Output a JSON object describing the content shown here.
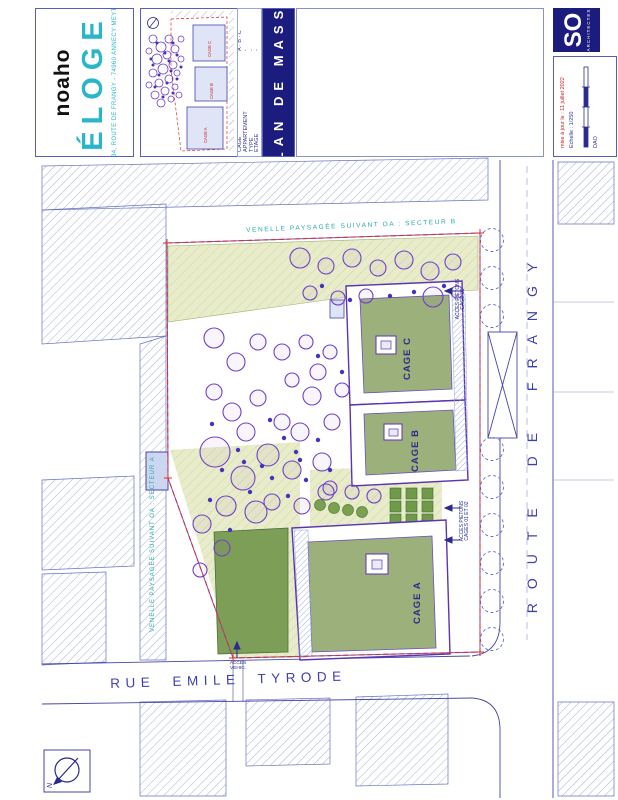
{
  "header": {
    "brand": {
      "name": "noaho",
      "project": "ÉLOGE",
      "address": "30 - 34, ROUTE DE FRANGY - 74960 ANNECY MEYTHET"
    },
    "cartouche": [
      {
        "label": "CAGE",
        "value": "A · B · C"
      },
      {
        "label": "APPARTEMENT",
        "value": "-"
      },
      {
        "label": "TYPE",
        "value": "-"
      },
      {
        "label": "ETAGE",
        "value": "-"
      }
    ],
    "banner_title": "PLAN DE MASSE",
    "architect": {
      "logo": "SO",
      "tagline": "architectes"
    },
    "infobox": {
      "updated": "mise à jour le : 11 juillet 2022",
      "scale": "Echelle : 1/250",
      "dao": "DAO"
    }
  },
  "plan": {
    "street_south": "RUE EMILE TYRODE",
    "street_east": "ROUTE DE FRANGY",
    "venelle_top": "VENELLE PAYSAGÉE SUIVANT OA : SECTEUR B",
    "venelle_left": "VENELLE PAYSAGÉE SUIVANT OA : SECTEUR A",
    "access_piet_c": {
      "line1": "ACCES PIETONS",
      "line2": "CAGE 03"
    },
    "access_piet_ab": {
      "line1": "ACCES PIETONS",
      "line2": "CAGES 01 ET 02"
    },
    "access_veh": {
      "line1": "ACCES",
      "line2": "VEHIC."
    },
    "north_label": "N",
    "buildings": [
      {
        "label": "CAGE A"
      },
      {
        "label": "CAGE B"
      },
      {
        "label": "CAGE C"
      }
    ],
    "minimap": {
      "labels": [
        "CAGE C",
        "CAGE B",
        "CAGE A"
      ]
    }
  },
  "colors": {
    "navy": "#4646a8",
    "purple_outline": "#5a35b0",
    "boundary_red": "#d93030",
    "teal": "#2aa8a8",
    "roof_green": "#9cb07c",
    "pale_green": "#e8ecca",
    "dark_green": "#7d9e56",
    "banner_navy": "#1c1c7e",
    "logo_teal": "#2ab6c9",
    "minimap_label_red": "#cc2222"
  }
}
